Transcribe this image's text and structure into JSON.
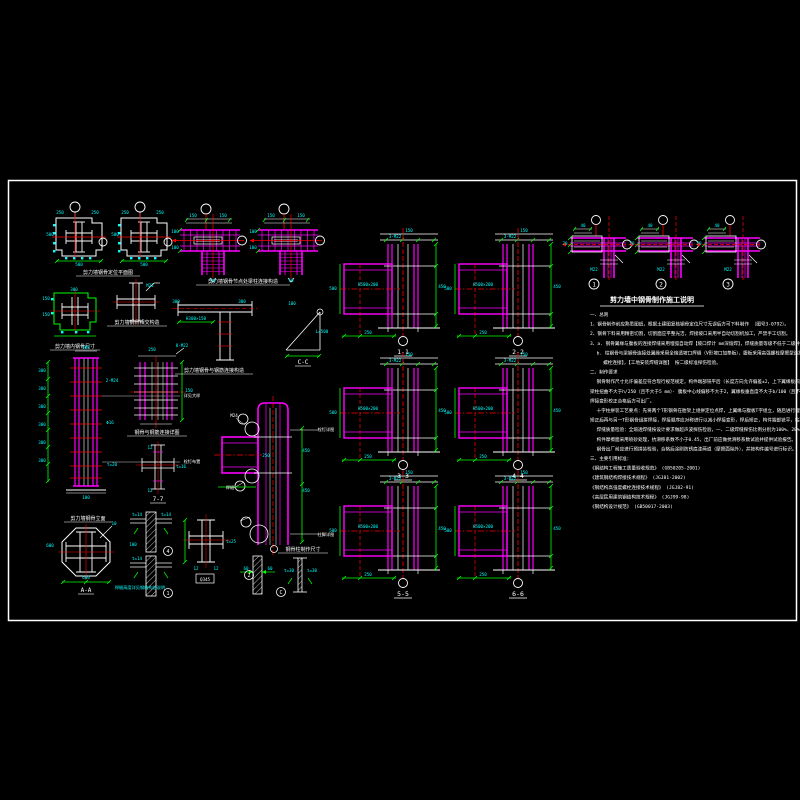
{
  "colors": {
    "background": "#000000",
    "frame": "#ffffff",
    "steel_magenta": "#ff00ff",
    "centerline_red": "#ff0000",
    "dimension_green": "#00ff00",
    "dim_text_cyan": "#00ffff",
    "text_white": "#ffffff"
  },
  "captions": {
    "c1": "剪力墙钢骨定位平面图",
    "c2": "剪力墙钢骨节点处梁柱连接构造",
    "c3": "剪力墙钢骨相交构造",
    "c4": "剪力墙内钢骨尺寸",
    "c5": "剪力墙钢骨与钢筋连接构造",
    "c6": "剪力墙钢骨立面",
    "c7": "钢骨与钢筋连接详图",
    "c8": "7-7",
    "c9": "A-A",
    "c10": "钢骨柱制作尺寸",
    "c11": "C-C"
  },
  "notes": {
    "title": "剪力墙中钢骨制作施工说明",
    "lines": [
      "一、总则",
      "1、钢骨制作前应熟悉图纸，根据土建图复核钢骨定位尺寸无误后方可下料制作 （图号3-0792）。",
      "2、钢骨下料采用精密切割，切割面应平整光洁，焊接坡口采用半自动切割机加工，严禁手工切割。",
      "3、a. 钢骨翼缘与腹板的连接焊缝采用埋弧自动焊【坡口焊计 mm深熔焊】，焊缝质量等级不低于二级并须探伤检验。",
      "   b. 柱钢骨与梁钢骨连接处翼缘采用全熔透坡口焊缝（V形坡口加垫板），腹板采用高强螺栓摩擦型连接，【M22及M24高强",
      "      螺栓连接】，【工地安装焊缝详图】 按二级标准探伤检验。",
      "二、制作要求",
      "   钢骨制作尺寸允许偏差应符合现行规范规定，构件端部铣平后（长度方向允许偏差±2，上下翼缘板间距允许偏差±2，",
      "梁柱扭曲不大于h/250（且不大于5 mm）· 腹板中心线偏移不大于2，翼缘板垂直度不大于b/100（且不大于3），十字柱角，",
      "焊接变形校正合格后方可出厂。",
      "   十字柱拼装工艺要点：先将两个T形钢骨在胎架上组拼定位点焊，上翼缘与腹板T字组立，随后进行埋弧焊接，在胎架上",
      "矫正后再与另一T形钢骨组拼焊接，焊接顺序应对称进行以减小焊接变形，焊后矫正，构件端部铣平，钻孔采用数控钻床加工。",
      "   焊缝质量检验：全熔透焊缝按设计要求做超声波探伤检验，一、二级焊缝探伤比例分别为100%、20%。",
      "   构件摩擦面采用喷砂处理，抗滑移系数不小于0.45，出厂前应做抗滑移系数试验并提供试验报告。",
      "   钢骨出厂前应进行预拼装检验，合格后涂刷防锈底漆两道（摩擦面除外），并按构件编号进行标识。",
      "三、主要引用标准：",
      "《钢结构工程施工质量验收规范》 (GB50205-2001)",
      "《建筑钢结构焊接技术规程》 (JGJ81-2002)",
      "《钢结构高强度螺栓连接技术规程》 (JGJ82-91)",
      "《高层民用建筑钢结构技术规程》 (JGJ99-98)",
      "《钢结构设计规范》 (GB50017-2003)"
    ]
  },
  "sections": {
    "origins": [
      [
        340,
        228
      ],
      [
        455,
        228
      ],
      [
        340,
        352
      ],
      [
        455,
        352
      ],
      [
        340,
        470
      ],
      [
        455,
        470
      ]
    ],
    "labels": [
      "1-1",
      "2-2",
      "3-3",
      "4-4",
      "5-5",
      "6-6"
    ],
    "dims": [
      {
        "dx": 69,
        "dy": 4,
        "t": "150"
      },
      {
        "dx": 55,
        "dy": 10,
        "t": "3-M22"
      },
      {
        "dx": 102,
        "dy": 60,
        "t": "450"
      },
      {
        "dx": 28,
        "dy": 58,
        "t": "H500×200"
      },
      {
        "dx": 28,
        "dy": 106,
        "t": "250"
      },
      {
        "dx": -7,
        "dy": 62,
        "t": "500"
      }
    ]
  },
  "corners": {
    "origins": [
      [
        570,
        214
      ],
      [
        637,
        214
      ],
      [
        704,
        214
      ]
    ],
    "labels": [
      "1",
      "2",
      "3"
    ],
    "dims": [
      {
        "dx": 13,
        "dy": 13,
        "t": "40"
      },
      {
        "dx": -5,
        "dy": 31,
        "t": "70"
      },
      {
        "dx": 24,
        "dy": 57,
        "t": "M22"
      }
    ]
  },
  "plans": {
    "origins": [
      [
        52,
        200
      ],
      [
        117,
        200
      ]
    ],
    "dims": [
      {
        "dx": 8,
        "dy": 14,
        "t": "250"
      },
      {
        "dx": 43,
        "dy": 14,
        "t": "250"
      },
      {
        "dx": 27,
        "dy": 66,
        "t": "500"
      },
      {
        "dx": -2,
        "dy": 36,
        "t": "500"
      }
    ]
  },
  "lgrids": {
    "origins": [
      [
        178,
        202
      ],
      [
        256,
        202
      ]
    ],
    "dims": [
      {
        "dx": 15,
        "dy": 15,
        "t": "150"
      },
      {
        "dx": 45,
        "dy": 15,
        "t": "150"
      },
      {
        "dx": -3,
        "dy": 31,
        "t": "100"
      },
      {
        "dx": -3,
        "dy": 47,
        "t": "100"
      },
      {
        "dx": 35,
        "dy": 80,
        "t": "50"
      }
    ]
  },
  "circled_marks": [
    {
      "x": 168,
      "y": 551,
      "t": "4"
    },
    {
      "x": 168,
      "y": 593,
      "t": "1"
    },
    {
      "x": 281,
      "y": 592,
      "t": "C"
    },
    {
      "x": 249,
      "y": 575,
      "t": "2"
    }
  ],
  "annotations": [
    {
      "t": "M22",
      "x": 150,
      "y": 287
    },
    {
      "t": "150",
      "x": 46,
      "y": 300
    },
    {
      "t": "150",
      "x": 46,
      "y": 316
    },
    {
      "t": "300",
      "x": 74,
      "y": 291
    },
    {
      "t": "300",
      "x": 176,
      "y": 303
    },
    {
      "t": "300",
      "x": 242,
      "y": 303
    },
    {
      "t": "H300×150",
      "x": 196,
      "y": 320
    },
    {
      "t": "100",
      "x": 292,
      "y": 305
    },
    {
      "t": "L=500",
      "x": 322,
      "y": 333
    },
    {
      "t": "300",
      "x": 42,
      "y": 372
    },
    {
      "t": "300",
      "x": 42,
      "y": 390
    },
    {
      "t": "300",
      "x": 42,
      "y": 408
    },
    {
      "t": "300",
      "x": 42,
      "y": 426
    },
    {
      "t": "300",
      "x": 42,
      "y": 444
    },
    {
      "t": "300",
      "x": 42,
      "y": 462
    },
    {
      "t": "500",
      "x": 86,
      "y": 349
    },
    {
      "t": "2-M24",
      "x": 112,
      "y": 382
    },
    {
      "t": "Φ16",
      "x": 110,
      "y": 424
    },
    {
      "t": "t=20",
      "x": 112,
      "y": 466
    },
    {
      "t": "100",
      "x": 86,
      "y": 499
    },
    {
      "t": "详见大样",
      "x": 192,
      "y": 397,
      "c": "wh"
    },
    {
      "t": "栓钉布置",
      "x": 192,
      "y": 463,
      "c": "wh"
    },
    {
      "t": "250",
      "x": 152,
      "y": 351
    },
    {
      "t": "8-M22",
      "x": 182,
      "y": 347
    },
    {
      "t": "150",
      "x": 189,
      "y": 392
    },
    {
      "t": "12",
      "x": 150,
      "y": 449
    },
    {
      "t": "t=16",
      "x": 181,
      "y": 468
    },
    {
      "t": "12",
      "x": 150,
      "y": 492
    },
    {
      "t": "10",
      "x": 114,
      "y": 525
    },
    {
      "t": "600",
      "x": 50,
      "y": 547
    },
    {
      "t": "600",
      "x": 86,
      "y": 579
    },
    {
      "t": "t=14",
      "x": 137,
      "y": 516
    },
    {
      "t": "t=14",
      "x": 166,
      "y": 516
    },
    {
      "t": "100",
      "x": 133,
      "y": 546
    },
    {
      "t": "t=14",
      "x": 137,
      "y": 560
    },
    {
      "t": "焊缝高度详见钢结构总说明",
      "x": 140,
      "y": 589
    },
    {
      "t": "12",
      "x": 196,
      "y": 570
    },
    {
      "t": "12",
      "x": 216,
      "y": 570
    },
    {
      "t": "t=25",
      "x": 231,
      "y": 543
    },
    {
      "t": "Q345",
      "x": 205,
      "y": 581,
      "c": "wh"
    },
    {
      "t": "M24",
      "x": 234,
      "y": 417,
      "c": "wh"
    },
    {
      "t": "焊缝",
      "x": 230,
      "y": 489,
      "c": "wh"
    },
    {
      "t": "栓钉详图",
      "x": 326,
      "y": 431,
      "c": "wh"
    },
    {
      "t": "柱脚详图",
      "x": 326,
      "y": 536,
      "c": "wh"
    },
    {
      "t": "450",
      "x": 306,
      "y": 452
    },
    {
      "t": "450",
      "x": 306,
      "y": 492
    },
    {
      "t": "250",
      "x": 266,
      "y": 457
    },
    {
      "t": "60",
      "x": 246,
      "y": 570
    },
    {
      "t": "60",
      "x": 270,
      "y": 570
    },
    {
      "t": "t=30",
      "x": 289,
      "y": 572
    },
    {
      "t": "t=30",
      "x": 312,
      "y": 572
    }
  ]
}
